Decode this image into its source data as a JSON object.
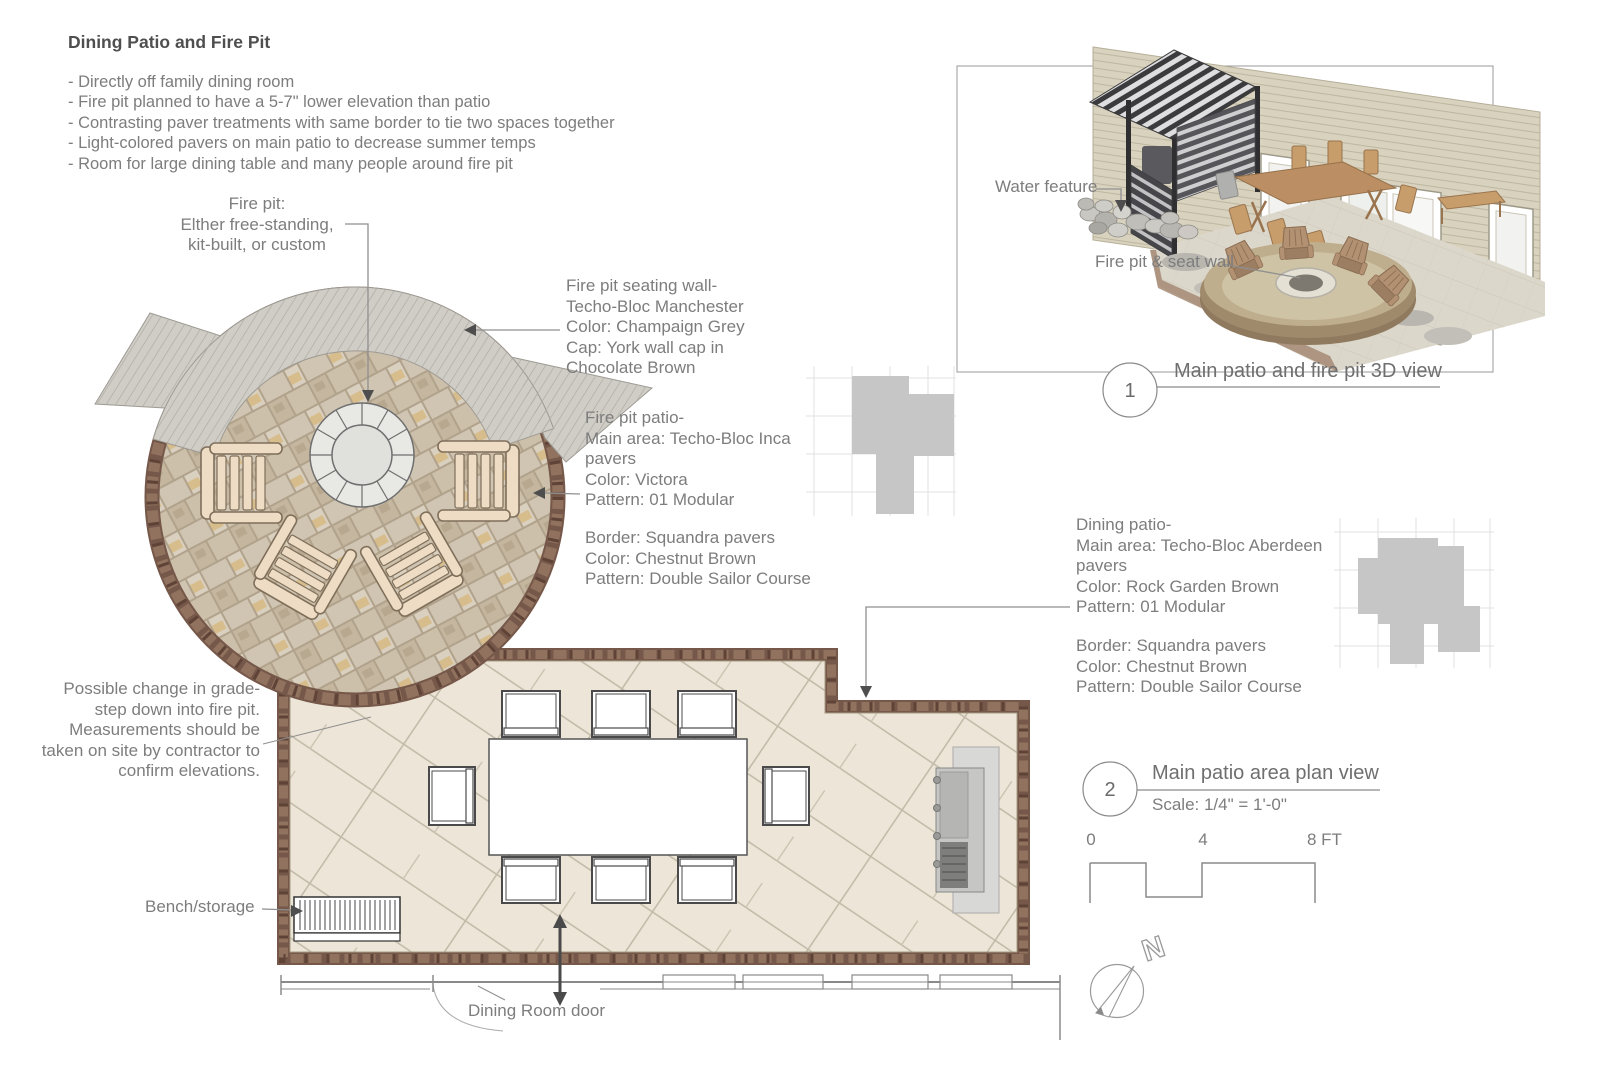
{
  "header": {
    "title": "Dining Patio and Fire Pit",
    "bullets": [
      "- Directly off family dining room",
      "- Fire pit planned to have a 5-7\" lower elevation than patio",
      "- Contrasting paver treatments with same border to tie two spaces together",
      "- Light-colored pavers on main patio to decrease summer temps",
      "- Room for large dining table and many people around fire pit"
    ]
  },
  "annotations": {
    "fire_pit": "Fire pit:\nElther free-standing,\nkit-built, or custom",
    "seating_wall": "Fire pit seating wall-\nTecho-Bloc Manchester\nColor: Champaign Grey\nCap: York wall cap in\nChocolate Brown",
    "fire_pit_patio": "Fire pit patio-\nMain area: Techo-Bloc Inca\npavers\nColor: Victora\nPattern: 01 Modular",
    "fire_pit_border": "Border: Squandra pavers\nColor: Chestnut Brown\nPattern: Double Sailor Course",
    "dining_patio": "Dining patio-\nMain area: Techo-Bloc Aberdeen\npavers\nColor: Rock Garden Brown\nPattern: 01 Modular",
    "dining_border": "Border: Squandra pavers\nColor: Chestnut Brown\nPattern: Double Sailor Course",
    "grade_note": "Possible change in grade-\nstep down into fire pit.\nMeasurements should be\ntaken on site by contractor to\nconfirm elevations.",
    "bench": "Bench/storage",
    "dining_door": "Dining Room door",
    "water_feature": "Water feature",
    "fire_pit_seat_wall": "Fire pit & seat wall"
  },
  "callouts": {
    "view3d": {
      "number": "1",
      "title": "Main patio and fire pit 3D view"
    },
    "plan": {
      "number": "2",
      "title": "Main patio area plan view",
      "subtitle": "Scale: 1/4\" = 1'-0\""
    }
  },
  "scale_bar": {
    "ticks": [
      "0",
      "4",
      "8 FT"
    ]
  },
  "compass": {
    "label": "N"
  },
  "colors": {
    "border_paver": "#76584a",
    "fire_pit_field": "#cfc5b2",
    "dining_field": "#ede6d8",
    "seat_wall": "#d0cdc7",
    "text": "#7d7d7d"
  }
}
